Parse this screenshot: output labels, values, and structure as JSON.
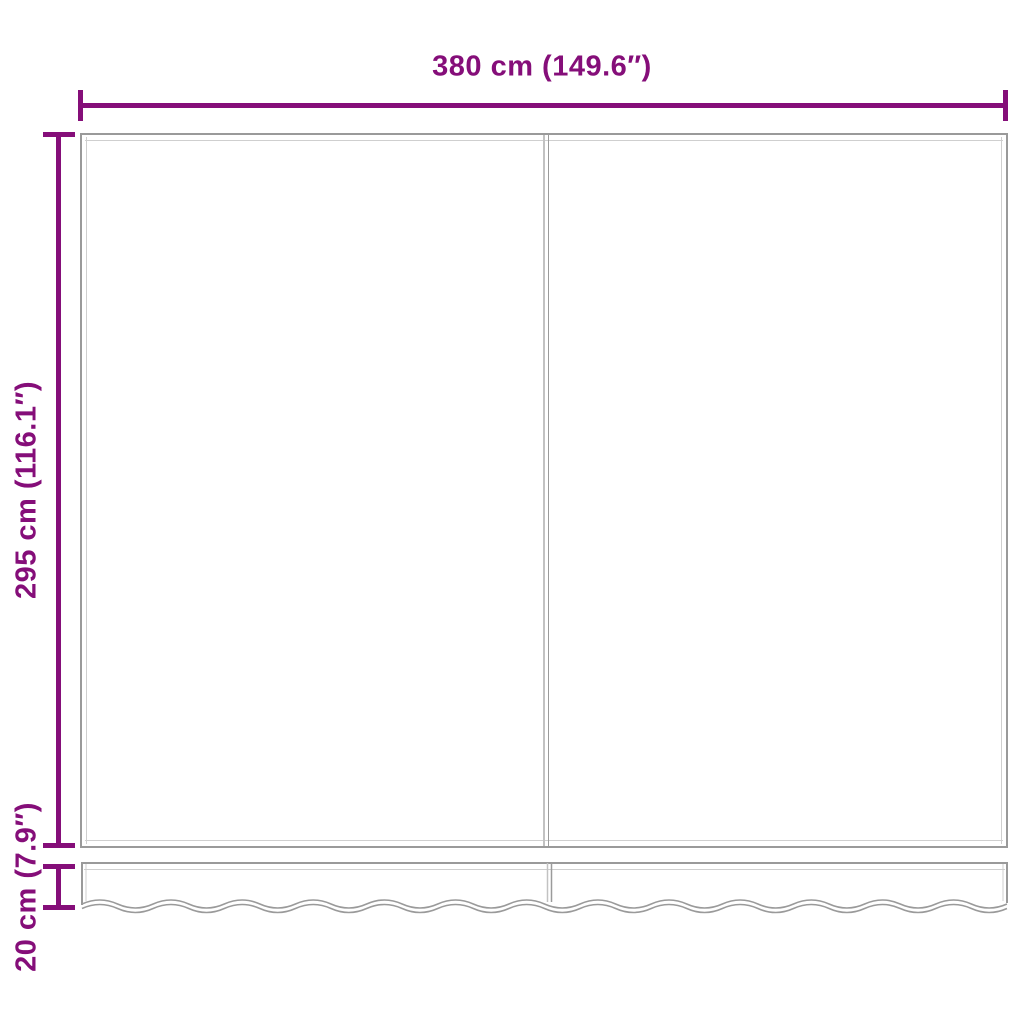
{
  "diagram": {
    "width_label": "380 cm (149.6″)",
    "height_label": "295 cm (116.1″)",
    "valance_height_label": "20 cm (7.9″)",
    "colors": {
      "dimension": "#850E79",
      "outline": "#9A9A9A",
      "inner_line": "#CFCFCF",
      "background": "#FFFFFF"
    }
  }
}
